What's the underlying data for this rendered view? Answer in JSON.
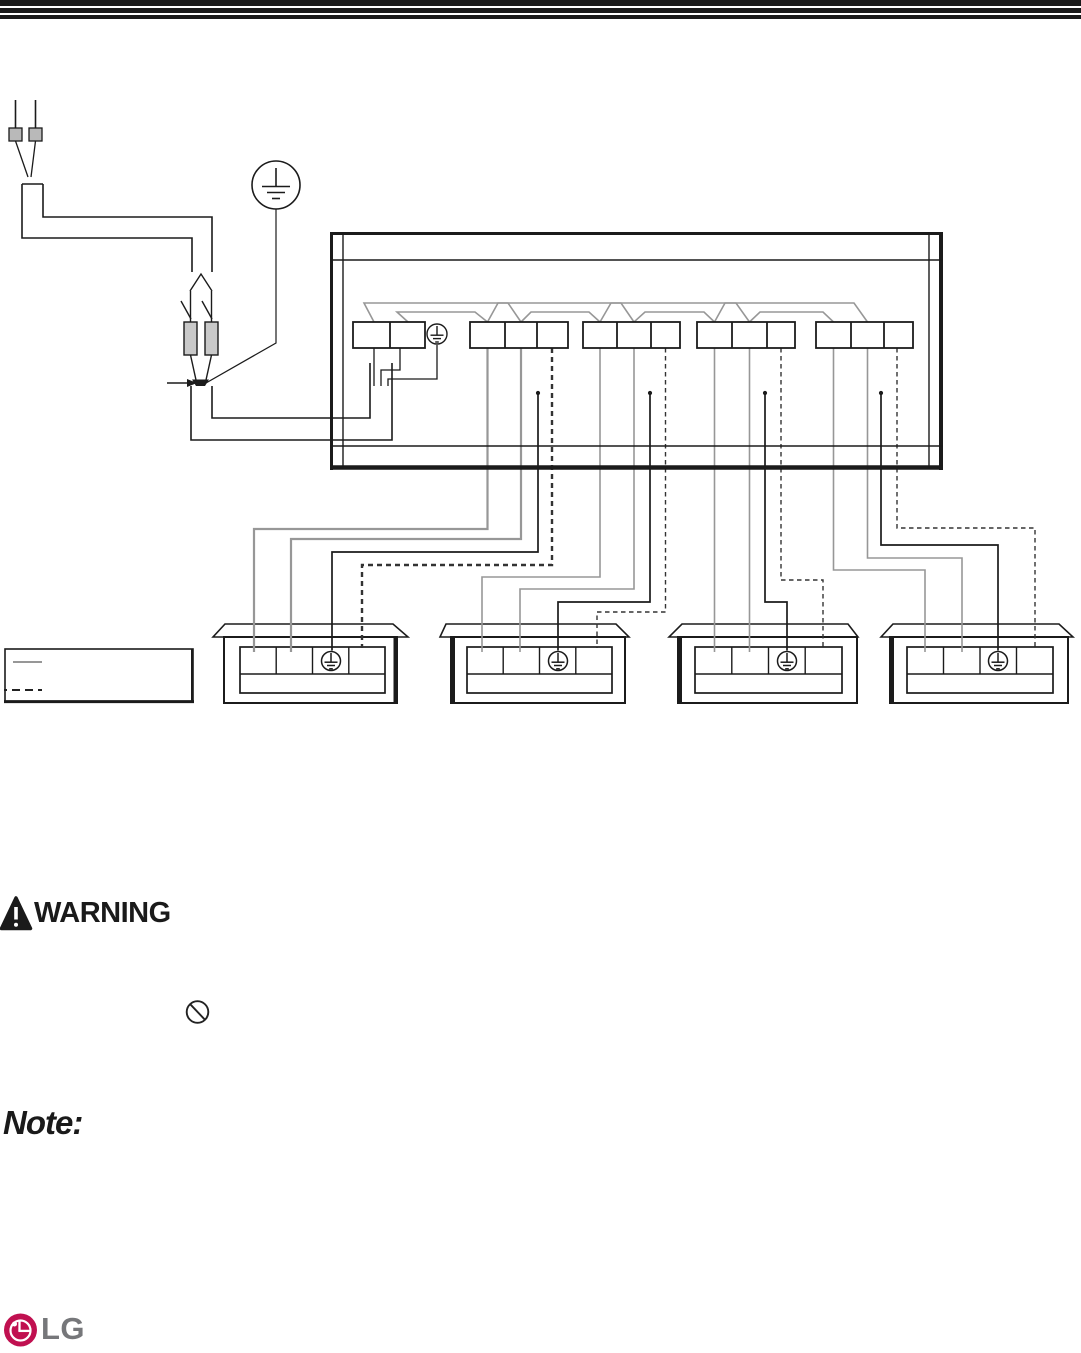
{
  "warning": {
    "title": "WARNING"
  },
  "note": {
    "label": "Note:"
  },
  "footer": {
    "logo_text": "LG"
  },
  "legend": {
    "items": [
      {
        "name": "solid-gray-line-sample"
      },
      {
        "name": "dashed-black-line-sample"
      }
    ]
  },
  "diagram": {
    "outdoor_terminal_groups": 4,
    "indoor_units": 4,
    "power_terminal_cells": 2,
    "indoor_terminal_cells_per_unit": 4,
    "ground_symbols": 6,
    "fuses": 2
  },
  "icons": {
    "warning_triangle": "exclamation-in-triangle",
    "prohibition": "circle-with-slash",
    "protective_earth": "earth-ground-in-circle",
    "arrow_right": "junction-pointer-arrow",
    "lg_logo": "lg-face-in-circle"
  },
  "colors": {
    "line_black": "#1b1b1b",
    "wire_gray": "#979797",
    "fuse_fill": "#c9c9c9",
    "plug_fill": "#b9b9b9",
    "lg_crimson": "#c01050",
    "lg_text_gray": "#76777a"
  }
}
